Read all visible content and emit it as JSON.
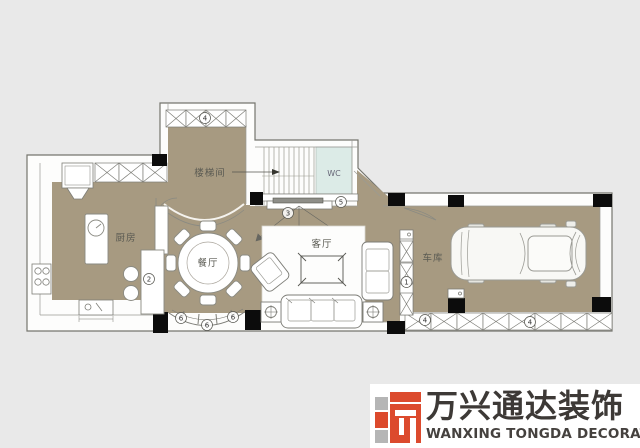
{
  "floorplan": {
    "rooms": {
      "kitchen": "厨房",
      "dining": "餐厅",
      "living": "客厅",
      "garage": "车库",
      "stairwell": "楼梯间",
      "wc": "WC"
    },
    "annotations": {
      "tower_window": "4",
      "tv_wall": "3",
      "wc_door": "5",
      "bar_counter": "2",
      "garage_cabinet": "1",
      "bay_window_left": "6",
      "bay_window_center": "6",
      "bay_window_right": "6",
      "garage_window_left": "4",
      "garage_window_right": "4"
    },
    "colors": {
      "floor_tan": "#a79a81",
      "wc_fill": "#dcebe7",
      "background": "#e9e9e9",
      "column_black": "#0c0c0c",
      "wall_line": "#75756e"
    }
  },
  "brand": {
    "logo_cn": "万兴通达装饰",
    "logo_en": "WANXING TONGDA DECORATION",
    "accent_red": "#dc4a2d",
    "accent_gray": "#b5b5b5"
  }
}
